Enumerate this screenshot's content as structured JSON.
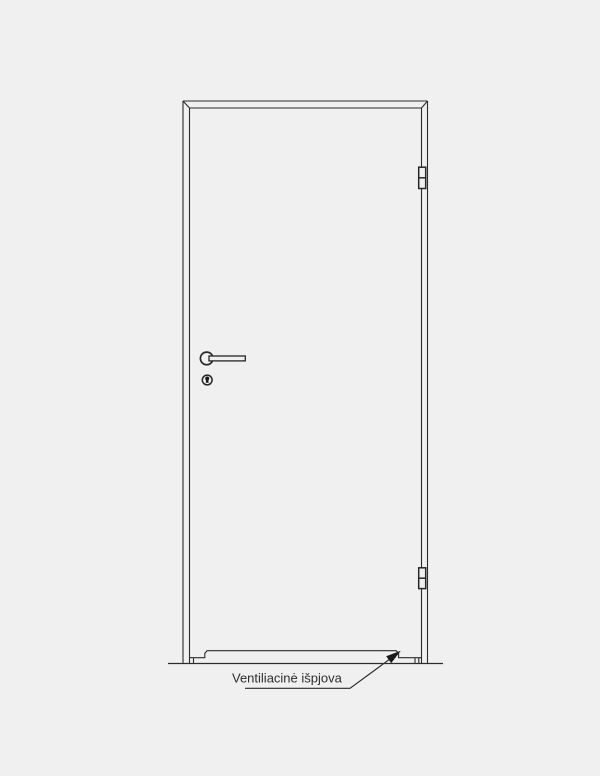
{
  "diagram": {
    "label_text": "Ventiliacinė išpjova",
    "colors": {
      "background": "#f0f0f0",
      "line": "#2b2b2b",
      "arrow_fill": "#1a1a1a",
      "text": "#2e2e2e"
    },
    "parts": [
      "door-frame",
      "door-leaf",
      "hinge-top",
      "hinge-bottom",
      "lever-handle",
      "keyhole",
      "ventilation-cutout",
      "floor-line",
      "leader-arrow",
      "ventilation-label"
    ]
  }
}
